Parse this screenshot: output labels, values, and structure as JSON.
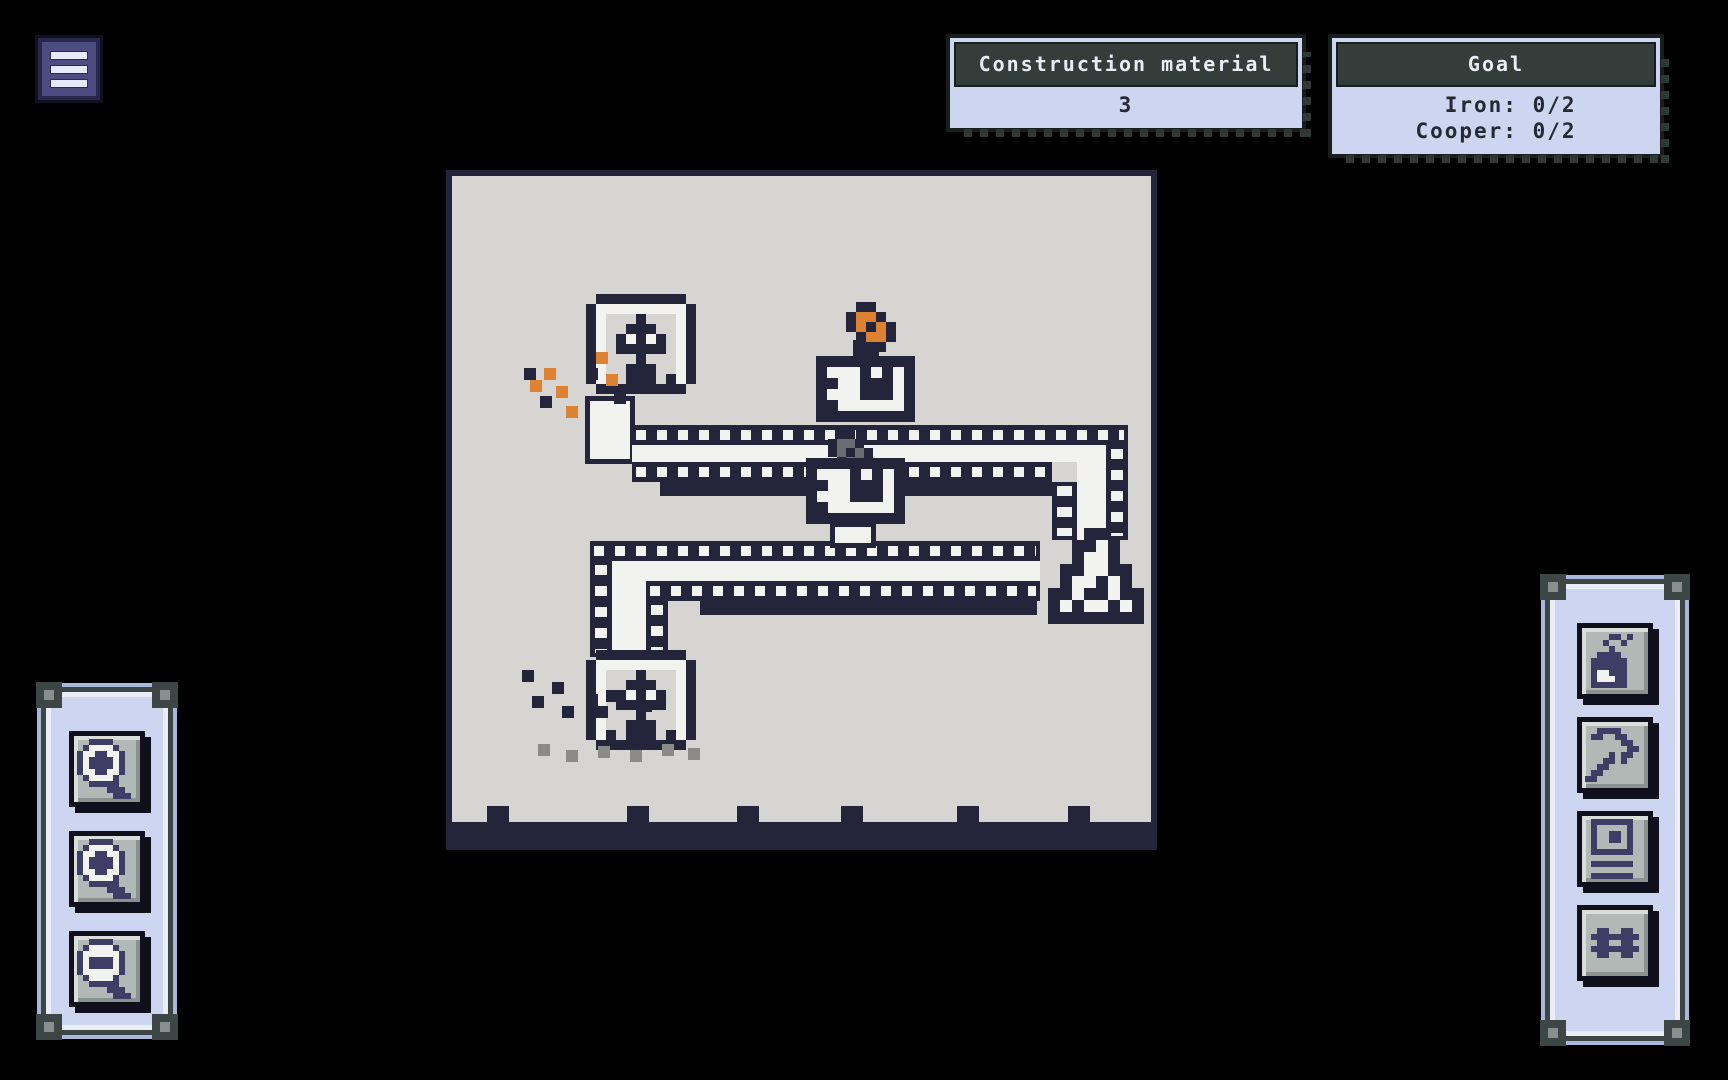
{
  "menu": {
    "icon": "hamburger-menu-icon"
  },
  "hud": {
    "construction": {
      "title": "Construction material",
      "value": "3"
    },
    "goal": {
      "title": "Goal",
      "lines": [
        "Iron: 0/2",
        "Cooper: 0/2"
      ]
    }
  },
  "left_toolbar": {
    "buttons": [
      {
        "name": "zoom-in",
        "icon": "zoom_in"
      },
      {
        "name": "zoom-in-alt",
        "icon": "zoom_in"
      },
      {
        "name": "zoom-out",
        "icon": "zoom_out"
      }
    ]
  },
  "right_toolbar": {
    "buttons": [
      {
        "name": "furnace-tool",
        "icon": "furnace_icon"
      },
      {
        "name": "mine-tool",
        "icon": "pickaxe_icon"
      },
      {
        "name": "storage-tool",
        "icon": "chest_icon"
      },
      {
        "name": "belt-tool",
        "icon": "rails_icon"
      }
    ]
  },
  "colors": {
    "background": "#000000",
    "board": "#d6d5d2",
    "dark_pixel": "#24243a",
    "white_pixel": "#f2f2ef",
    "copper": "#dd8233",
    "iron_gray": "#6b6b72",
    "stone_gray": "#8a8a88",
    "panel_lavender": "#ccd6f1",
    "panel_header": "#333d3a",
    "button_face": "#b2b8b6",
    "menu_indigo": "#4c4c80",
    "icon_navy": "#3d3d66"
  },
  "board": {
    "palette": {
      "D": "#24243a",
      "W": "#f2f2ef",
      "O": "#dd8233",
      "S": "#6b6b72",
      "G": "#8a8a88",
      "P": "#3d3d66"
    },
    "sprites": {
      "miner": {
        "rows": [
          "..DDDDDDDDD..",
          ".DWWWWWWWWWD.",
          ".DW...D...WD.",
          ".DW..DDD..WD.",
          ".DW.DWDWD.WD.",
          ".DW.DDDDD.WD.",
          ".DW...D...WD.",
          ".DW..DDD..WD.",
          ".DWD.DDD.DWD.",
          "..DDDDDDDDD.."
        ]
      },
      "machine": {
        "rows": [
          "DDDDDDDDD",
          "DWWWDWDWD",
          "DDWWDDDWD",
          "DWWWDDDWD",
          "DDWWWWWWD",
          "DDDDDDDDD"
        ]
      },
      "flask": {
        "rows": [
          "...DD...",
          "..DDWD..",
          "..DWWD..",
          ".DDWWDD.",
          ".DWWDWD.",
          "DDWDDWDD",
          "DWDWWDWD",
          "DDDDDDDD"
        ]
      },
      "ore_copper": {
        "rows": [
          ".DD..",
          "DOOD.",
          "DODOD",
          ".DOOD",
          "..DD."
        ]
      },
      "ore_iron": {
        "rows": [
          ".DD..",
          "DSSD.",
          "DSDSD",
          ".DSSD",
          "..DD."
        ]
      },
      "zoom_in": {
        "rows": [
          "..PPPP....",
          ".PWWWWP...",
          "PWWPPWWP..",
          "PWPPPPWP..",
          "PWPPPPWP..",
          "PWWPPWWP..",
          ".PWWWWP...",
          "..PPPPP...",
          ".....PPP..",
          "......PPP."
        ]
      },
      "zoom_out": {
        "rows": [
          "..PPPP....",
          ".PWWWWP...",
          "PWWWWWWP..",
          "PWPPPPWP..",
          "PWPPPPWP..",
          "PWWWWWWP..",
          ".PWWWWP...",
          "..PPPPP...",
          ".....PPP..",
          "......PPP."
        ]
      },
      "furnace_icon": {
        "rows": [
          "....PP.P..",
          "...P..P...",
          "....P.....",
          "..PPPP....",
          ".PPPPPP...",
          ".PPPPPP...",
          ".PWWPPP...",
          ".PWWWPP...",
          ".PPPPPP..."
        ]
      },
      "pickaxe_icon": {
        "rows": [
          "..PPPP....",
          ".PP..PP...",
          "......PP..",
          ".......PP.",
          "....P.PP..",
          "...PP.P...",
          "..PP......",
          ".PP.......",
          "PP........"
        ]
      },
      "chest_icon": {
        "rows": [
          ".PPPPPPP..",
          ".P.....P..",
          ".P..PP.P..",
          ".P..PP.P..",
          ".P.....P..",
          ".PPPPPPP..",
          "..........",
          ".PPPPPPP..",
          "..........",
          ".PPPPPPP.."
        ]
      },
      "rails_icon": {
        "rows": [
          "..PP..PP..",
          ".PPPPPPPP.",
          "..PP..PP..",
          ".PPPPPPPP.",
          "..PP..PP.."
        ]
      }
    },
    "elements": [
      {
        "t": "rect",
        "x": 446,
        "y": 170,
        "w": 711,
        "h": 6,
        "c": "D",
        "n": "board-edge-top",
        "i": false
      },
      {
        "t": "rect",
        "x": 446,
        "y": 170,
        "w": 6,
        "h": 680,
        "c": "D",
        "n": "board-edge-left",
        "i": false
      },
      {
        "t": "rect",
        "x": 1151,
        "y": 170,
        "w": 6,
        "h": 680,
        "c": "D",
        "n": "board-edge-right",
        "i": false
      },
      {
        "t": "rect",
        "x": 446,
        "y": 822,
        "w": 711,
        "h": 28,
        "c": "D",
        "n": "board-bottom-wall",
        "i": false
      },
      {
        "t": "rect",
        "x": 487,
        "y": 806,
        "w": 22,
        "h": 16,
        "c": "D",
        "n": "wall-notch",
        "i": false
      },
      {
        "t": "rect",
        "x": 627,
        "y": 806,
        "w": 22,
        "h": 16,
        "c": "D",
        "n": "wall-notch",
        "i": false
      },
      {
        "t": "rect",
        "x": 737,
        "y": 806,
        "w": 22,
        "h": 16,
        "c": "D",
        "n": "wall-notch",
        "i": false
      },
      {
        "t": "rect",
        "x": 841,
        "y": 806,
        "w": 22,
        "h": 16,
        "c": "D",
        "n": "wall-notch",
        "i": false
      },
      {
        "t": "rect",
        "x": 957,
        "y": 806,
        "w": 22,
        "h": 16,
        "c": "D",
        "n": "wall-notch",
        "i": false
      },
      {
        "t": "rect",
        "x": 1068,
        "y": 806,
        "w": 22,
        "h": 16,
        "c": "D",
        "n": "wall-notch",
        "i": false
      },
      {
        "t": "rect",
        "x": 585,
        "y": 396,
        "w": 50,
        "h": 68,
        "c": "CH",
        "n": "miner-chute",
        "i": false
      },
      {
        "t": "rail",
        "dir": "h",
        "x": 632,
        "y": 425,
        "w": 496,
        "h": 20,
        "n": "conveyor-belt",
        "i": true
      },
      {
        "t": "rect",
        "x": 632,
        "y": 445,
        "w": 474,
        "h": 17,
        "c": "W",
        "n": "conveyor-belt-surface",
        "i": false
      },
      {
        "t": "rail",
        "dir": "h",
        "x": 632,
        "y": 462,
        "w": 420,
        "h": 20,
        "n": "conveyor-belt",
        "i": true
      },
      {
        "t": "rect",
        "x": 660,
        "y": 482,
        "w": 392,
        "h": 14,
        "c": "D",
        "n": "conveyor-shadow",
        "i": false
      },
      {
        "t": "rail",
        "dir": "v",
        "x": 1106,
        "y": 445,
        "w": 22,
        "h": 95,
        "n": "conveyor-belt",
        "i": true
      },
      {
        "t": "rect",
        "x": 1077,
        "y": 462,
        "w": 29,
        "h": 78,
        "c": "W",
        "n": "conveyor-belt-surface",
        "i": false
      },
      {
        "t": "rail",
        "dir": "v",
        "x": 1052,
        "y": 482,
        "w": 25,
        "h": 58,
        "n": "conveyor-belt",
        "i": true
      },
      {
        "t": "rail",
        "dir": "h",
        "x": 590,
        "y": 541,
        "w": 450,
        "h": 20,
        "n": "conveyor-belt",
        "i": true
      },
      {
        "t": "rect",
        "x": 612,
        "y": 561,
        "w": 428,
        "h": 20,
        "c": "W",
        "n": "conveyor-belt-surface",
        "i": false
      },
      {
        "t": "rail",
        "dir": "h",
        "x": 646,
        "y": 581,
        "w": 394,
        "h": 20,
        "n": "conveyor-belt",
        "i": true
      },
      {
        "t": "rect",
        "x": 700,
        "y": 601,
        "w": 337,
        "h": 14,
        "c": "D",
        "n": "conveyor-shadow",
        "i": false
      },
      {
        "t": "rail",
        "dir": "v",
        "x": 590,
        "y": 561,
        "w": 22,
        "h": 96,
        "n": "conveyor-belt",
        "i": true
      },
      {
        "t": "rect",
        "x": 612,
        "y": 581,
        "w": 34,
        "h": 76,
        "c": "W",
        "n": "conveyor-belt-surface",
        "i": false
      },
      {
        "t": "rail",
        "dir": "v",
        "x": 646,
        "y": 601,
        "w": 22,
        "h": 56,
        "n": "conveyor-belt",
        "i": true
      },
      {
        "t": "sprite",
        "s": "ore_iron",
        "x": 828,
        "y": 430,
        "px": 9,
        "n": "iron-ore-item",
        "i": false
      },
      {
        "t": "rect",
        "x": 853,
        "y": 340,
        "w": 26,
        "h": 18,
        "c": "D",
        "n": "smelter-chimney",
        "i": false
      },
      {
        "t": "sprite",
        "s": "machine",
        "x": 816,
        "y": 356,
        "px": 11,
        "n": "smelter-top",
        "i": true
      },
      {
        "t": "sprite",
        "s": "ore_copper",
        "x": 846,
        "y": 302,
        "px": 10,
        "n": "copper-ore-icon",
        "i": false
      },
      {
        "t": "sprite",
        "s": "machine",
        "x": 806,
        "y": 458,
        "px": 11,
        "n": "smelter-bottom",
        "i": true
      },
      {
        "t": "rect",
        "x": 830,
        "y": 522,
        "w": 46,
        "h": 26,
        "c": "CH",
        "n": "machine-chute",
        "i": false
      },
      {
        "t": "sprite",
        "s": "miner",
        "x": 576,
        "y": 294,
        "px": 10,
        "n": "drill-miner-top",
        "i": true
      },
      {
        "t": "sprite",
        "s": "miner",
        "x": 576,
        "y": 650,
        "px": 10,
        "n": "drill-miner-bottom",
        "i": true
      },
      {
        "t": "sprite",
        "s": "flask",
        "x": 1048,
        "y": 528,
        "px": 12,
        "n": "collector-flask",
        "i": true
      },
      {
        "t": "px",
        "x": 596,
        "y": 352,
        "c": "O"
      },
      {
        "t": "px",
        "x": 544,
        "y": 368,
        "c": "O"
      },
      {
        "t": "px",
        "x": 606,
        "y": 374,
        "c": "O"
      },
      {
        "t": "px",
        "x": 556,
        "y": 386,
        "c": "O"
      },
      {
        "t": "px",
        "x": 530,
        "y": 380,
        "c": "O"
      },
      {
        "t": "px",
        "x": 566,
        "y": 406,
        "c": "O"
      },
      {
        "t": "px",
        "x": 524,
        "y": 368,
        "c": "D"
      },
      {
        "t": "px",
        "x": 586,
        "y": 368,
        "c": "D"
      },
      {
        "t": "px",
        "x": 614,
        "y": 392,
        "c": "D"
      },
      {
        "t": "px",
        "x": 540,
        "y": 396,
        "c": "D"
      },
      {
        "t": "px",
        "x": 522,
        "y": 670,
        "c": "D"
      },
      {
        "t": "px",
        "x": 552,
        "y": 682,
        "c": "D"
      },
      {
        "t": "px",
        "x": 586,
        "y": 694,
        "c": "D"
      },
      {
        "t": "px",
        "x": 532,
        "y": 696,
        "c": "D"
      },
      {
        "t": "px",
        "x": 562,
        "y": 706,
        "c": "D"
      },
      {
        "t": "px",
        "x": 606,
        "y": 690,
        "c": "D"
      },
      {
        "t": "px",
        "x": 596,
        "y": 706,
        "c": "D"
      },
      {
        "t": "px",
        "x": 640,
        "y": 700,
        "c": "D"
      },
      {
        "t": "px",
        "x": 538,
        "y": 744,
        "c": "G"
      },
      {
        "t": "px",
        "x": 566,
        "y": 750,
        "c": "G"
      },
      {
        "t": "px",
        "x": 598,
        "y": 746,
        "c": "G"
      },
      {
        "t": "px",
        "x": 630,
        "y": 750,
        "c": "G"
      },
      {
        "t": "px",
        "x": 662,
        "y": 744,
        "c": "G"
      },
      {
        "t": "px",
        "x": 688,
        "y": 748,
        "c": "G"
      }
    ]
  }
}
